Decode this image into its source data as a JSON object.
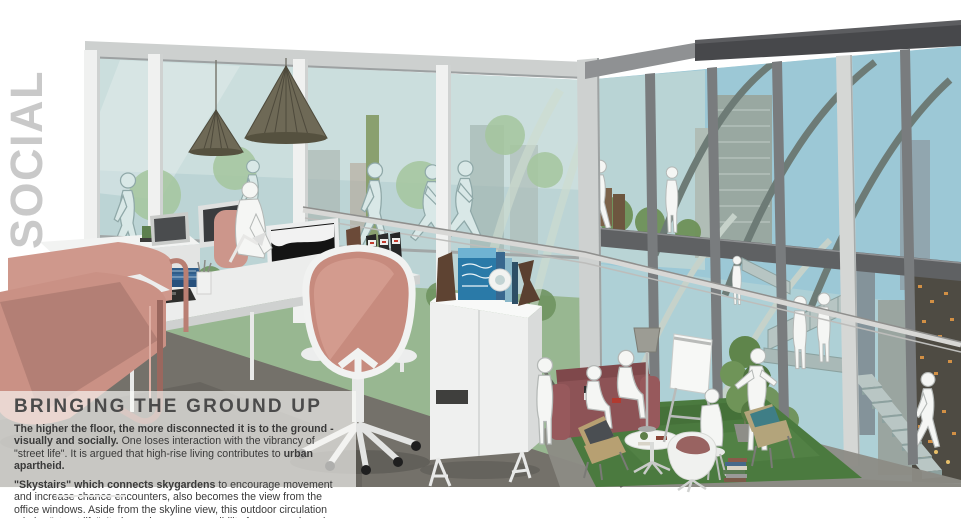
{
  "side_label": "SOCIAL",
  "panel": {
    "heading": "BRINGING THE GROUND UP",
    "p1_bold_lead": "The higher the floor, the more disconnected it is to the ground - visually and socially.",
    "p1_text": " One loses interaction with the vibrancy of \"street life\". It is argued that high-rise living contributes to ",
    "p1_bold_end": "urban apartheid.",
    "p2_bold_lead": "\"Skystairs\" which connects skygardens",
    "p2_text": " to encourage movement and increase chance encounters, also becomes the view from the office windows. Aside from the skyline view, this outdoor circulation mimics \"street life\". It also enhances accessibility for companies who are renting multiple floors."
  },
  "colors": {
    "chair_pink": "#c78b7e",
    "lounge_chair_pink": "#ca9185",
    "sofa_maroon": "#8d5356",
    "rug_green": "#4b7a3f",
    "glass_left": "#bcd4d5",
    "sky_right": "#9cc8d6",
    "fascia_dark": "#47484b",
    "heading_text": "#4b4b4b",
    "body_text": "#3a3a3a",
    "side_label_gray": "#c9c9c9",
    "panel_overlay": "rgba(250,250,248,0.66)"
  }
}
